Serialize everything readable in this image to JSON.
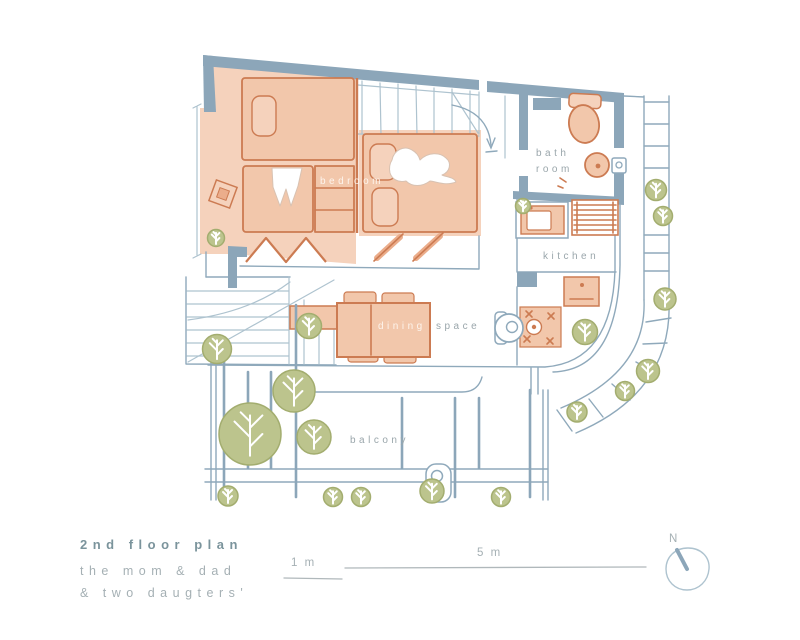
{
  "title_block": {
    "title": "2nd floor plan",
    "subtitle_line1": "the mom & dad",
    "subtitle_line2": "& two daugters'"
  },
  "rooms": {
    "bedroom": {
      "label": "bedroom"
    },
    "bathroom": {
      "line1": "bath",
      "line2": "room"
    },
    "kitchen": {
      "label": "kitchen"
    },
    "dining": {
      "word1": "dining",
      "word2": "space"
    },
    "balcony": {
      "label": "balcony"
    }
  },
  "scale_bar": {
    "minor": "1 m",
    "major": "5 m"
  },
  "compass": {
    "label": "N"
  },
  "colors": {
    "wall": "#8CA6B9",
    "line": "#8FA9BB",
    "line_soft": "#AEC3CF",
    "salmon": "#F2C7AB",
    "salmon_mid": "#EBAD8B",
    "salmon_light": "#F5D2BC",
    "salmon_line": "#CC7B52",
    "tree": "#BCC48D",
    "tree_line": "#A3AD6F",
    "label": "#9AA6AB",
    "title_color": "#7B949C",
    "subtitle_color": "#A5B0B4",
    "scale_line": "#B0B8BB"
  }
}
